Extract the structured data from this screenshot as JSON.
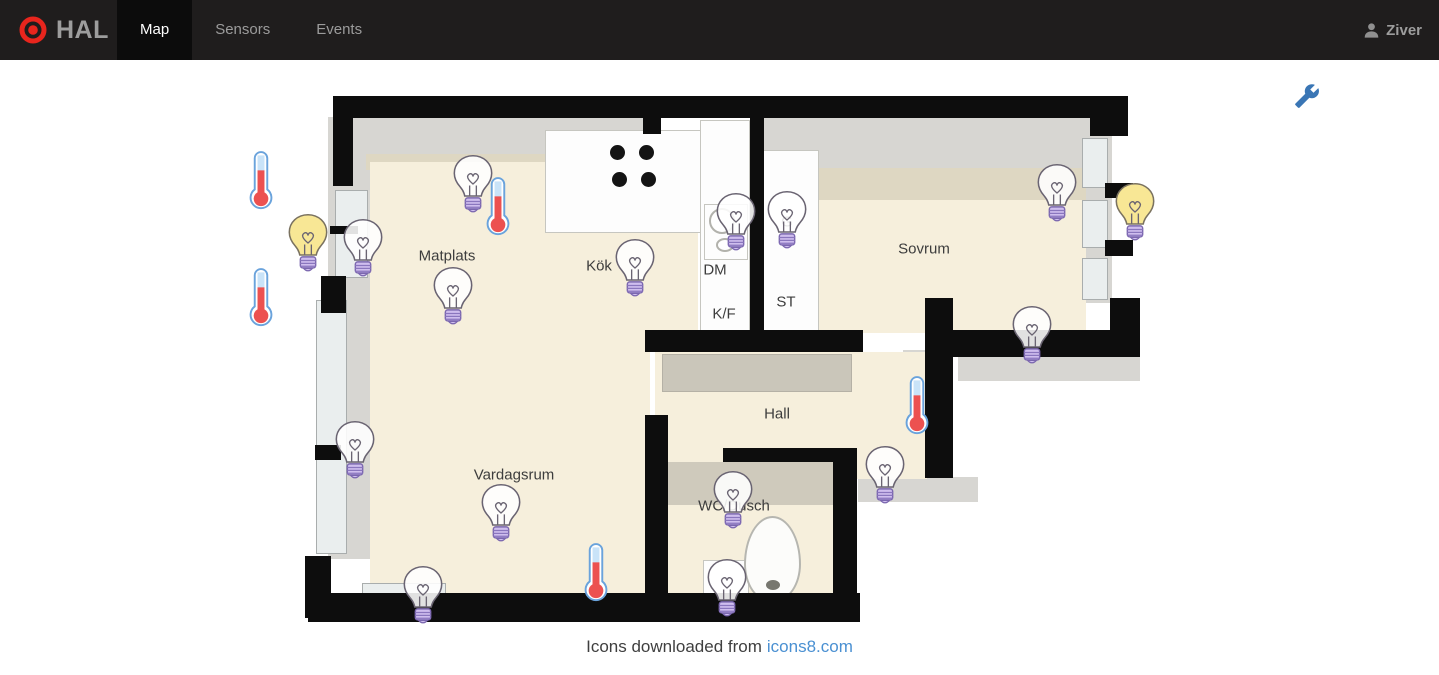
{
  "header": {
    "brand": "HAL",
    "tabs": [
      {
        "label": "Map",
        "active": true
      },
      {
        "label": "Sensors",
        "active": false
      },
      {
        "label": "Events",
        "active": false
      }
    ],
    "user": "Ziver"
  },
  "map": {
    "settings_icon": "wrench-icon",
    "room_labels": [
      {
        "text": "Matplats",
        "x": 447,
        "y": 256
      },
      {
        "text": "Kök",
        "x": 599,
        "y": 266
      },
      {
        "text": "Sovrum",
        "x": 924,
        "y": 249
      },
      {
        "text": "Hall",
        "x": 777,
        "y": 414
      },
      {
        "text": "Vardagsrum",
        "x": 514,
        "y": 475
      },
      {
        "text": "WC/Dusch",
        "x": 734,
        "y": 506
      }
    ],
    "appliance_labels": [
      {
        "text": "DM",
        "x": 715,
        "y": 270
      },
      {
        "text": "K/F",
        "x": 724,
        "y": 314
      },
      {
        "text": "ST",
        "x": 786,
        "y": 302
      },
      {
        "text": "G",
        "x": 787,
        "y": 222
      }
    ],
    "light_bulbs": [
      {
        "x": 473,
        "y": 184,
        "state": "off"
      },
      {
        "x": 308,
        "y": 243,
        "state": "on"
      },
      {
        "x": 363,
        "y": 248,
        "state": "off"
      },
      {
        "x": 453,
        "y": 296,
        "state": "off"
      },
      {
        "x": 635,
        "y": 268,
        "state": "off"
      },
      {
        "x": 736,
        "y": 222,
        "state": "off"
      },
      {
        "x": 787,
        "y": 220,
        "state": "off"
      },
      {
        "x": 1057,
        "y": 193,
        "state": "off"
      },
      {
        "x": 1135,
        "y": 212,
        "state": "on"
      },
      {
        "x": 1032,
        "y": 335,
        "state": "off"
      },
      {
        "x": 885,
        "y": 475,
        "state": "off"
      },
      {
        "x": 355,
        "y": 450,
        "state": "off"
      },
      {
        "x": 501,
        "y": 513,
        "state": "off"
      },
      {
        "x": 423,
        "y": 595,
        "state": "off"
      },
      {
        "x": 733,
        "y": 500,
        "state": "off"
      },
      {
        "x": 727,
        "y": 588,
        "state": "off"
      }
    ],
    "thermometers": [
      {
        "x": 261,
        "y": 180
      },
      {
        "x": 261,
        "y": 297
      },
      {
        "x": 498,
        "y": 206
      },
      {
        "x": 917,
        "y": 405
      },
      {
        "x": 596,
        "y": 572
      }
    ]
  },
  "footer": {
    "text": "Icons downloaded from",
    "link_text": "icons8.com"
  },
  "colors": {
    "navbar_bg": "#1f1d1d",
    "active_tab_bg": "#0c0c0c",
    "nav_text": "#9b9b9b",
    "brand_red": "#e8251d",
    "floor_beige": "#f6efdc",
    "wall_black": "#0d0d0d",
    "link_blue": "#4a90d2",
    "wrench_blue": "#3a76b5",
    "bulb_on_yellow": "#f8e795",
    "bulb_base_purple": "#cfbeee",
    "thermometer_red": "#ec5150",
    "thermometer_blue": "#c9e3f8"
  }
}
